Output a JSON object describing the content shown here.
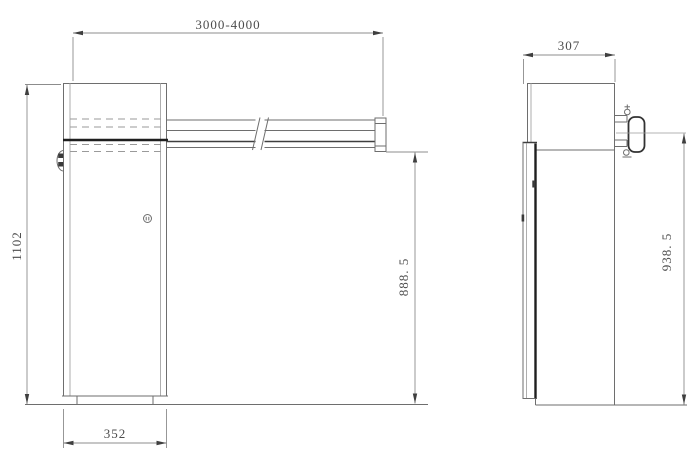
{
  "drawing": {
    "background_color": "#ffffff",
    "line_color": "#6e6e6e",
    "thick_line_color": "#1f1f1f",
    "dimension_line_color": "#8c8c8c",
    "text_color": "#4c4c4c",
    "front_view": {
      "boom_length": "3000-4000",
      "overall_height": "1102",
      "base_width": "352",
      "boom_clearance_height": "888. 5"
    },
    "side_view": {
      "cabinet_depth": "307",
      "boom_axis_height": "938. 5"
    }
  }
}
